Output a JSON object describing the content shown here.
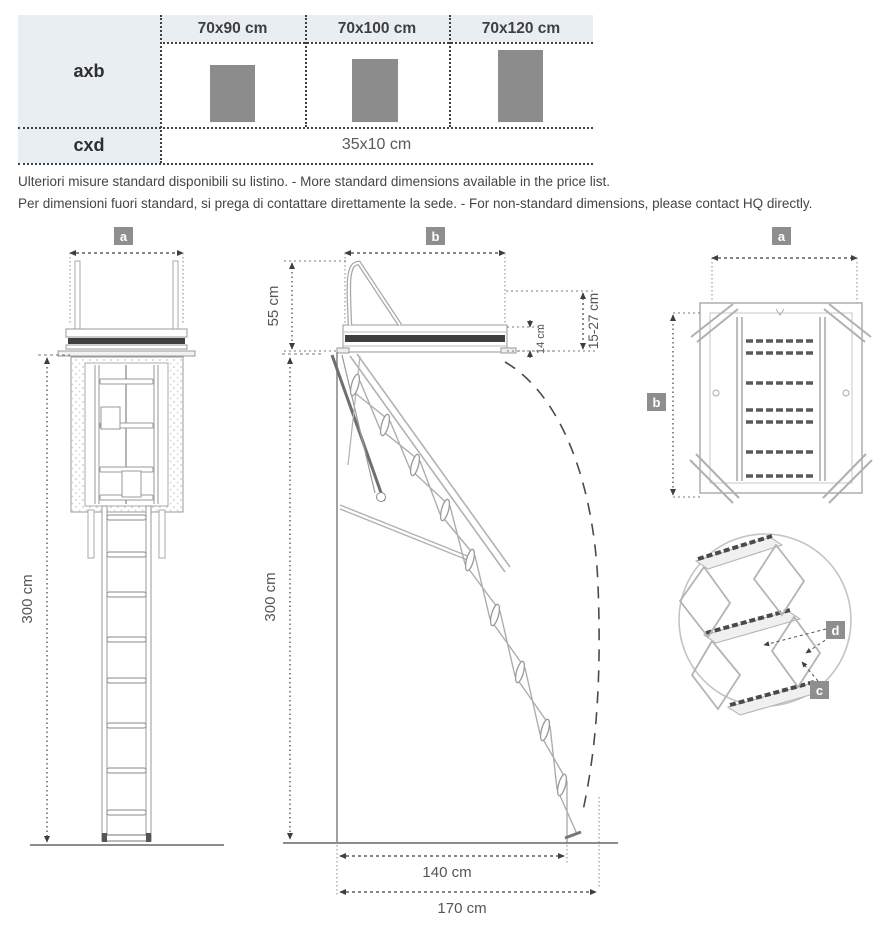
{
  "page": {
    "title": "Retractable loft ladder standard dimensions sheet",
    "background": "#ffffff"
  },
  "table": {
    "corner_row1_label": "axb",
    "corner_row2_label": "cxd",
    "columns": [
      {
        "label": "70x90 cm"
      },
      {
        "label": "70x100 cm"
      },
      {
        "label": "70x120 cm"
      }
    ],
    "cxd_value": "35x10 cm"
  },
  "notes": {
    "line1": "Ulteriori misure standard disponibili su listino. - More standard dimensions available in the price list.",
    "line2": "Per dimensioni fuori standard, si prega di contattare direttamente la sede. - For non-standard dimensions, please contact HQ directly."
  },
  "drawings": {
    "front_view": {
      "width_label": "a",
      "height_dim": "300 cm"
    },
    "side_view": {
      "width_label": "b",
      "top_dim": "55 cm",
      "ceiling_thickness_dim": "14 cm",
      "ceiling_range_dim": "15-27 cm",
      "height_dim": "300 cm",
      "floor_dim_inner": "140 cm",
      "floor_dim_outer": "170 cm"
    },
    "top_view": {
      "width_label": "a",
      "depth_label": "b"
    },
    "detail_view": {
      "step_depth_label": "d",
      "step_width_label": "c"
    }
  },
  "colors": {
    "table_header_bg": "#e9eef3",
    "size_rect_gray": "#8c8c8c",
    "dim_label_box": "#8e8e8e",
    "dim_line": "#3f3f3f",
    "dim_text": "#555555",
    "drawing_line": "#a8a8a8",
    "seal_dark": "#3f3f3f",
    "body_text": "#454545"
  }
}
